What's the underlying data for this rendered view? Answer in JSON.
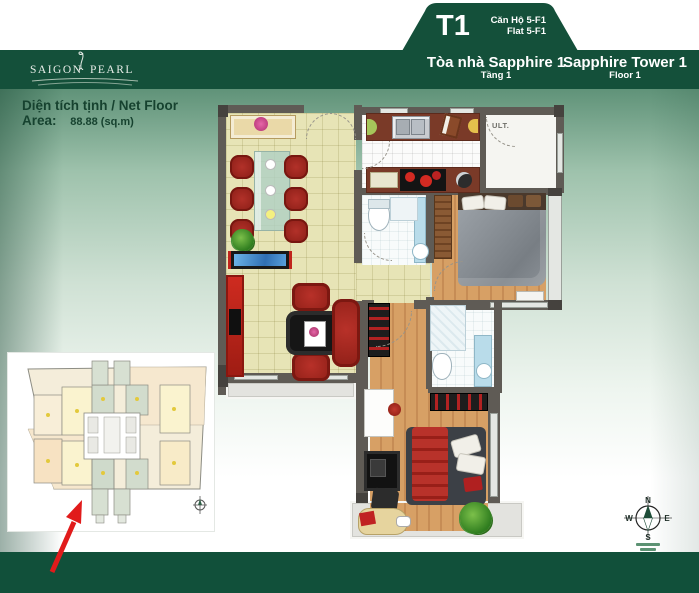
{
  "header": {
    "unit_code": "T1",
    "unit_name_vi": "Căn Hộ 5-F1",
    "unit_name_en": "Flat 5-F1",
    "building_name_vi": "Tòa nhà Sapphire 1",
    "floor_vi": "Tầng 1",
    "building_name_en": "Sapphire Tower 1",
    "floor_en": "Floor 1"
  },
  "logo": {
    "brand_left": "SAIGON",
    "brand_right": "PEARL"
  },
  "area": {
    "label": "Diện tích tịnh / Net Floor Area:",
    "value": "88.88 (sq.m)"
  },
  "floor_plan": {
    "utility_label": "ULT."
  },
  "compass": {
    "north": "N",
    "east": "E",
    "south": "S",
    "west": "W"
  },
  "colors": {
    "header_green": "#14503a",
    "footer_green": "#11503a",
    "background_green": "#5f9278",
    "tile_beige": "#e7e4b6",
    "wood_floor": "#d7a065",
    "counter_brown": "#7a3a28",
    "furniture_red": "#b23129",
    "aquarium_blue": "#4596d8",
    "bathroom_blue": "#b9dcea",
    "arrow_red": "#e11b1b"
  }
}
